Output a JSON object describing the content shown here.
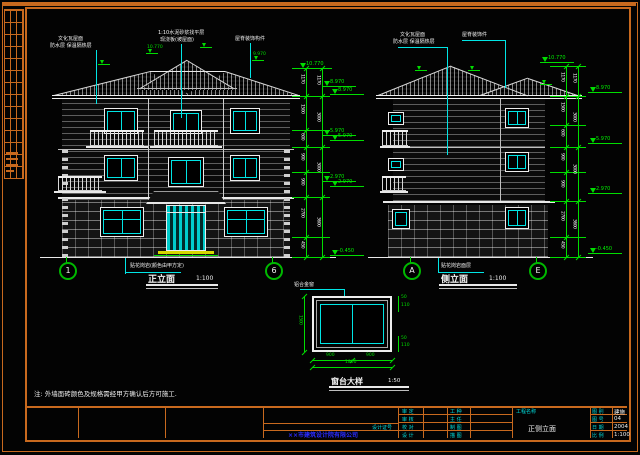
{
  "note": "注: 外墙面砖颜色及规格需经甲方确认后方可施工.",
  "front": {
    "title": "正立面",
    "scale": "1:100",
    "marker_left": "1",
    "marker_right": "6",
    "anno1a": "文化瓦屋面",
    "anno1b": "防水层 保温隔热层",
    "anno2a": "1:10水泥砂浆找平层",
    "anno2b": "现浇板(坡屋面)",
    "anno3": "屋脊装饰构件",
    "ground_leader": "贴花岗岩(颜色由甲方定)",
    "ridge_level": "10.770",
    "flag1": "10.770",
    "flag2": "9.970",
    "levels": [
      {
        "v": "8.970"
      },
      {
        "v": "5.970"
      },
      {
        "v": "2.970"
      },
      {
        "v": "-0.450"
      }
    ],
    "dims_inner": [
      "1170",
      "1500",
      "600",
      "900",
      "900",
      "2700",
      "450"
    ],
    "dims_outer": [
      "1170",
      "3000",
      "3000",
      "3600"
    ]
  },
  "side": {
    "title": "侧立面",
    "scale": "1:100",
    "marker_left": "A",
    "marker_right": "E",
    "anno1a": "文化瓦屋面",
    "anno1b": "防水层 保温隔热层",
    "anno2": "屋脊装饰件",
    "ground_leader": "贴花岗岩面层",
    "ridge_level": "10.770",
    "levels_left": [
      {
        "v": "8.970"
      },
      {
        "v": "5.970"
      },
      {
        "v": "2.970"
      }
    ],
    "levels_right": [
      {
        "v": "8.970"
      },
      {
        "v": "5.970"
      },
      {
        "v": "2.970"
      },
      {
        "v": "-0.450"
      }
    ],
    "dims_inner": [
      "1170",
      "1500",
      "600",
      "900",
      "900",
      "2700",
      "450"
    ],
    "dims_outer": [
      "1170",
      "3000",
      "3000",
      "3600"
    ]
  },
  "detail": {
    "title": "窗台大样",
    "scale": "1:50",
    "leader": "铝合金窗",
    "dim_left": "1500",
    "dim_bottom_a": "900",
    "dim_bottom_b": "900",
    "dim_bottom_total": "1800",
    "dim_rt1": "50",
    "dim_rt2": "110",
    "dim_rb1": "50",
    "dim_rb2": "110"
  },
  "titleblock": {
    "col1_labels": [
      {
        "t": "审 定"
      },
      {
        "t": "审 核"
      },
      {
        "t": "校 对"
      },
      {
        "t": "设 计"
      }
    ],
    "col2_labels": [
      {
        "t": "工 种"
      },
      {
        "t": "主 任"
      },
      {
        "t": "制 图"
      },
      {
        "t": "描 图"
      }
    ],
    "project_label": "工程名称",
    "drawing_title": "正侧立面",
    "right_rows": [
      {
        "k": "图 别",
        "v": "建施"
      },
      {
        "k": "图 号",
        "v": "04"
      },
      {
        "k": "日 期",
        "v": "2004"
      },
      {
        "k": "比 例",
        "v": "1:100"
      }
    ],
    "cert_label": "设计证号",
    "company": "××市建筑设计院有限公司"
  }
}
